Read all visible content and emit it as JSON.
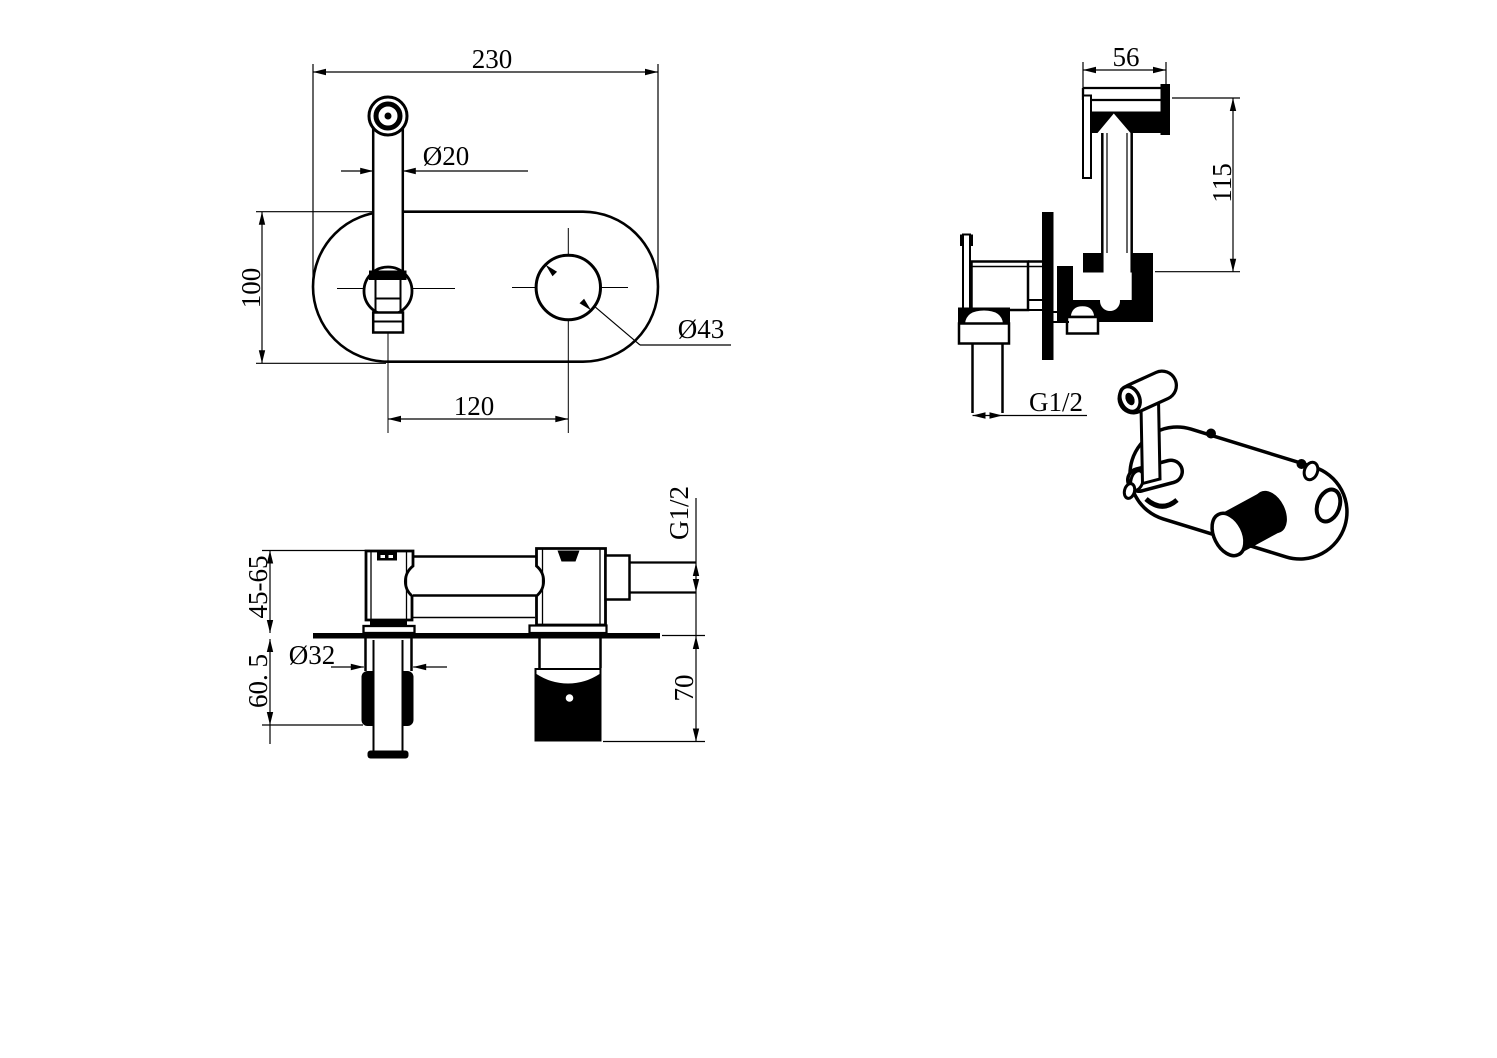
{
  "page": {
    "background": "#ffffff",
    "line_color": "#000000"
  },
  "drawing": {
    "type": "technical-dimension-drawing",
    "subject": "wall-mounted bidet sprayer mixer"
  },
  "dims": {
    "front_width": "230",
    "front_spout_diameter": "Ø20",
    "front_plate_height": "100",
    "front_hole_spacing": "120",
    "front_hole_diameter": "Ø43",
    "side_head_width": "56",
    "side_height": "115",
    "side_inlet_thread": "G1/2",
    "section_embed_depth": "45-65",
    "section_handle_depth": "60. 5",
    "section_sleeve_diameter": "Ø32",
    "section_spout_depth": "70",
    "section_outlet_thread": "G1/2"
  }
}
